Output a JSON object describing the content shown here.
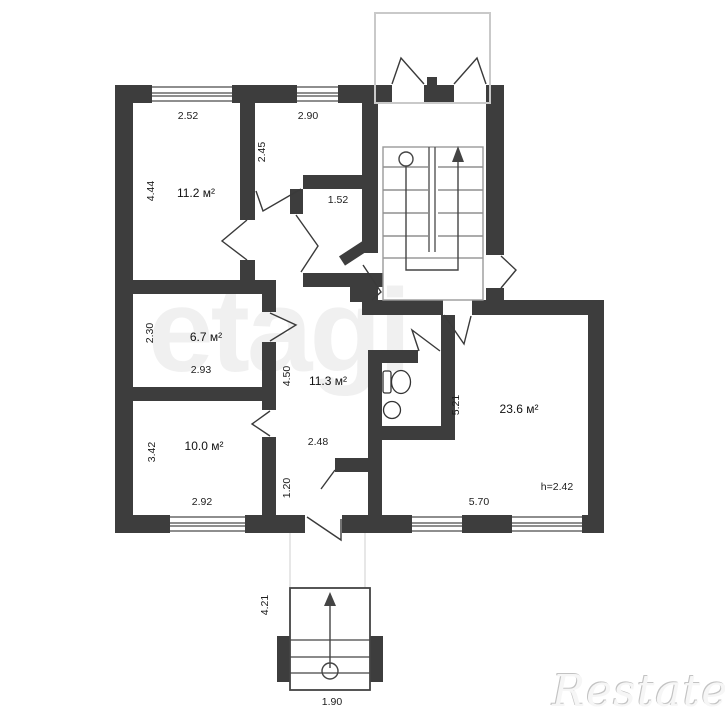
{
  "labels": {
    "d252": "2.52",
    "d290": "2.90",
    "r1area": "11.2 м²",
    "d444": "4.44",
    "d245": "2.45",
    "d152": "1.52",
    "r3area": "6.7 м²",
    "d230": "2.30",
    "d293": "2.93",
    "r4area": "10.0 м²",
    "d342": "3.42",
    "d292": "2.92",
    "hallarea": "11.3 м²",
    "d450": "4.50",
    "d248": "2.48",
    "d120": "1.20",
    "livarea": "23.6 м²",
    "d521": "5.21",
    "d570": "5.70",
    "h242": "h=2.42",
    "d421": "4.21",
    "d190": "1.90"
  },
  "watermarks": {
    "center": "etagi",
    "brand": "Restate"
  }
}
